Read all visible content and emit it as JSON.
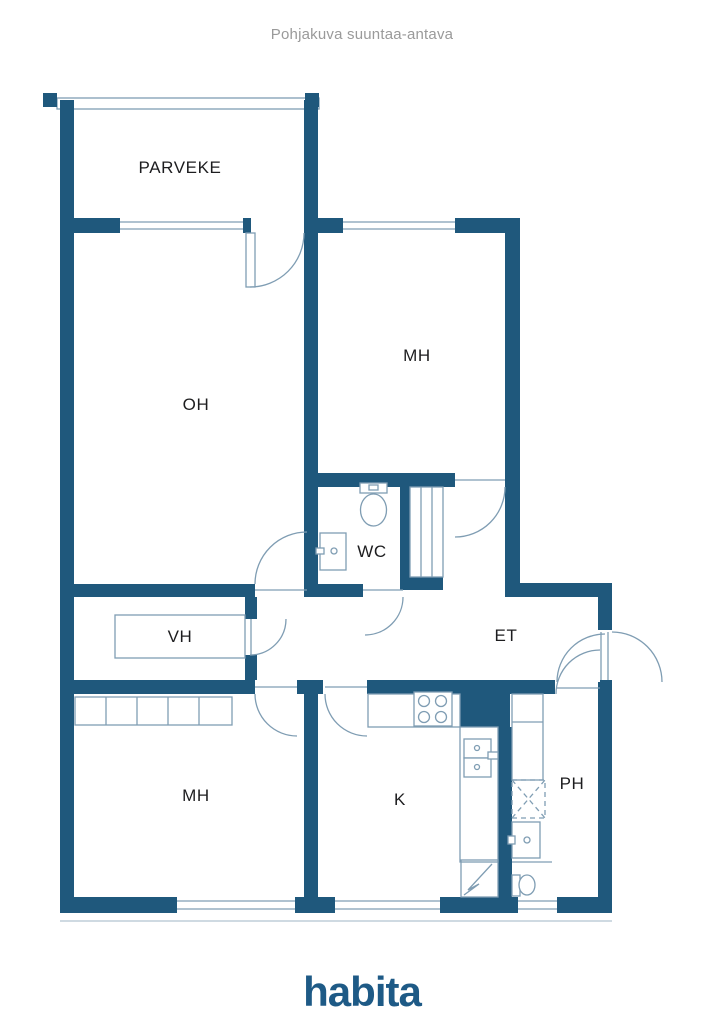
{
  "header": {
    "title": "Pohjakuva suuntaa-antava"
  },
  "floorplan": {
    "rooms": {
      "balcony": "PARVEKE",
      "living_room": "OH",
      "bedroom_top": "MH",
      "wc": "WC",
      "closet": "VH",
      "entrance": "ET",
      "bedroom_bottom": "MH",
      "kitchen": "K",
      "bathroom": "PH"
    }
  },
  "footer": {
    "logo_text": "habita"
  },
  "colors": {
    "wall": "#1f587c",
    "line": "#7f9db3",
    "label": "#1d1d1f",
    "title": "#9a9a9a",
    "logo": "#1e5a86",
    "background": "#ffffff"
  }
}
